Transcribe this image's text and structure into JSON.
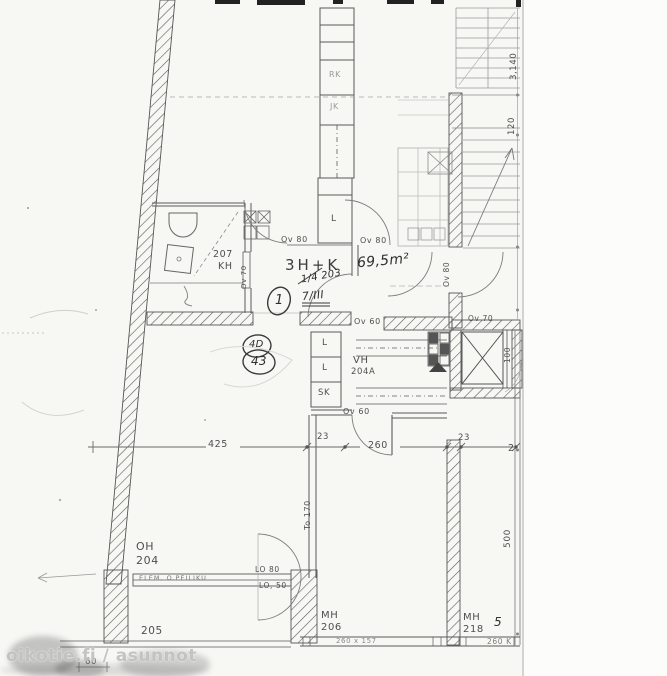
{
  "watermark": {
    "label": "oikotie.fi / asunnot"
  },
  "colors": {
    "paper": "#f7f7f4",
    "ink": "#5a5a5a",
    "hand_ink": "#333333",
    "watermark": "#bebebc",
    "wall_hatch": "#4f4f4f"
  },
  "title_block": {
    "apartment_type": "3H+K",
    "area": "69,5m²",
    "unit_number": "1",
    "note_upper": "1/4 203",
    "note_lower": "7/III",
    "stamp_top": "4D",
    "stamp_bottom": "43"
  },
  "rooms": {
    "bathroom": {
      "number": "207",
      "abbr": "KH"
    },
    "living": {
      "abbr": "OH",
      "number": "204"
    },
    "walkin": {
      "abbr": "VH",
      "number": "204A"
    },
    "bedroom1": {
      "abbr": "MH",
      "number": "206"
    },
    "bedroom2": {
      "abbr": "MH",
      "number": "218",
      "hand_mark": "5"
    },
    "balcony": {
      "number": "205"
    }
  },
  "closets": {
    "hall_closet": "L",
    "closet_1": "L",
    "closet_2": "L",
    "cleaning_closet": "SK",
    "fridge": "RK",
    "freezer": "JK"
  },
  "doors": {
    "ov80_a": "Ov 80",
    "ov80_b": "Ov 80",
    "ov80_entry": "Ov 80",
    "ov70_bath": "Ov 70",
    "ov70_hall": "Ov 70",
    "ov60_kitchen": "Ov 60",
    "ov60_vh": "Ov 60",
    "balcony_door": "LO 80",
    "balcony_window": "LO, 50"
  },
  "dimensions": {
    "living_width": "425",
    "wall_a": "23",
    "bedroom_width": "260",
    "wall_b": "23",
    "partial": "2",
    "door_opening": "To 170",
    "bedroom_depth": "500",
    "shaft": "100",
    "stair_a": "3,140",
    "stair_b": "120",
    "balcony_width": "60",
    "element_label": "ELEM. O.PEILIKU",
    "window_left": "260 x 157",
    "window_right": "260 K"
  }
}
